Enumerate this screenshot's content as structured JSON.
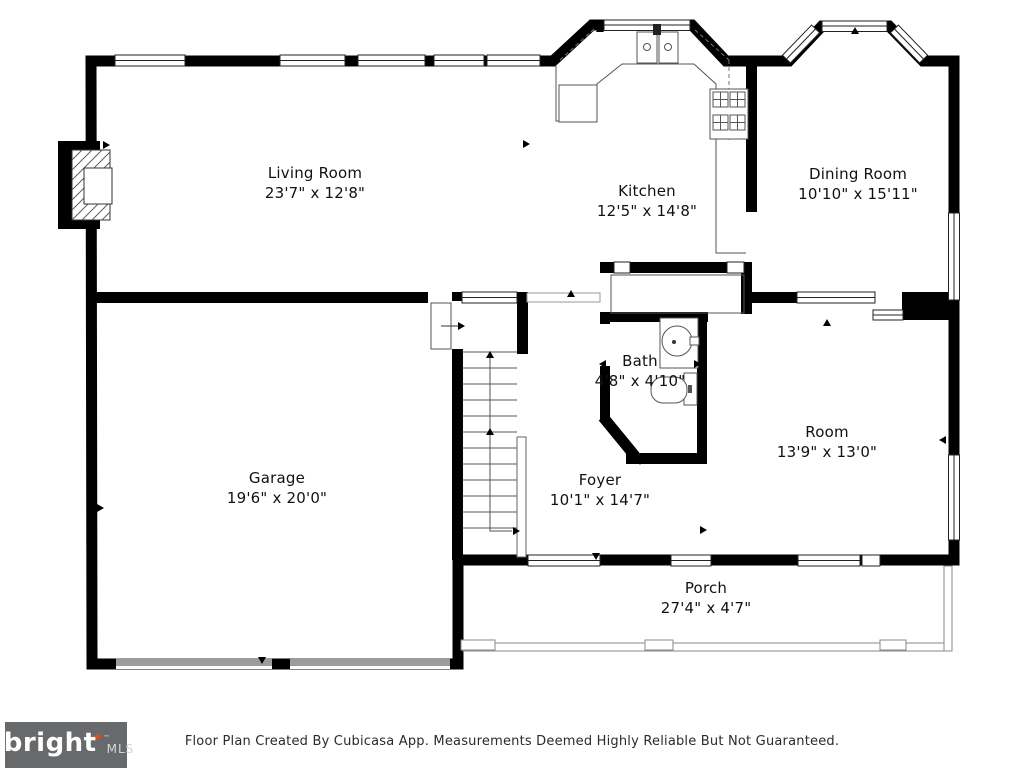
{
  "plan": {
    "rooms": {
      "living_room": {
        "name": "Living Room",
        "dims": "23'7\" x 12'8\""
      },
      "kitchen": {
        "name": "Kitchen",
        "dims": "12'5\" x 14'8\""
      },
      "dining_room": {
        "name": "Dining Room",
        "dims": "10'10\" x 15'11\""
      },
      "bath": {
        "name": "Bath",
        "dims": "4'8\" x 4'10\""
      },
      "room": {
        "name": "Room",
        "dims": "13'9\" x 13'0\""
      },
      "foyer": {
        "name": "Foyer",
        "dims": "10'1\" x 14'7\""
      },
      "garage": {
        "name": "Garage",
        "dims": "19'6\" x 20'0\""
      },
      "porch": {
        "name": "Porch",
        "dims": "27'4\" x 4'7\""
      }
    },
    "fixtures": [
      "fireplace",
      "kitchen-sink",
      "refrigerator",
      "stove",
      "bathroom-sink",
      "toilet",
      "stairs",
      "garage-door",
      "bay-window"
    ]
  },
  "footer": {
    "logo_primary": "bright",
    "logo_secondary": "MLS",
    "logo_tm": "™",
    "disclaimer": "Floor Plan Created By Cubicasa App. Measurements Deemed Highly Reliable But Not Guaranteed."
  },
  "colors": {
    "wall": "#000000",
    "background": "#ffffff",
    "garage_door": "#9c9c9c",
    "logo_background": "#68696b",
    "logo_accent": "#e0521c",
    "label_text": "#111111"
  }
}
